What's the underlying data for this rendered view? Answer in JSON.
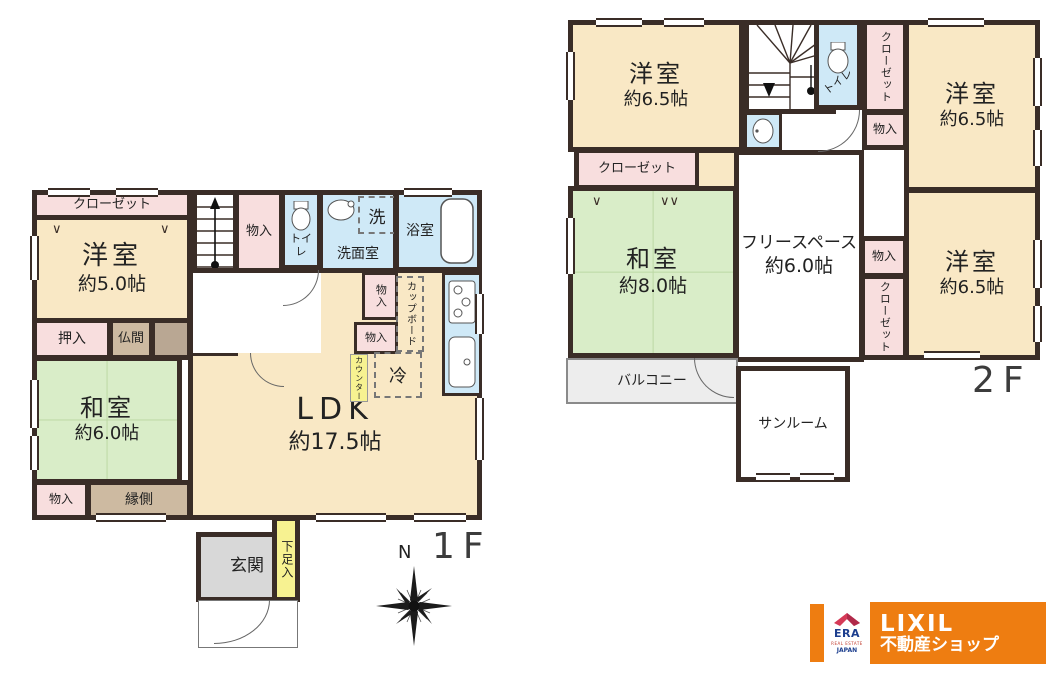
{
  "common": {
    "storage": "物入",
    "closet": "クローゼット",
    "toilet": "トイレ"
  },
  "floor1": {
    "floor_label": "1F",
    "compass_north": "N",
    "western_room": {
      "name": "洋室",
      "size": "約5.0帖"
    },
    "japanese_room": {
      "name": "和室",
      "size": "約6.0帖"
    },
    "ldk": {
      "name": "LDK",
      "size": "約17.5帖"
    },
    "oshiire": "押入",
    "butsuma": "仏間",
    "engawa": "縁側",
    "washroom": "洗面室",
    "washer": "洗",
    "bathroom": "浴室",
    "cupboard": "カップボード",
    "counter": "カウンター",
    "fridge": "冷",
    "genkan": "玄関",
    "shoe_storage": "下足入"
  },
  "floor2": {
    "floor_label": "2F",
    "western_room_nw": {
      "name": "洋室",
      "size": "約6.5帖"
    },
    "western_room_ne": {
      "name": "洋室",
      "size": "約6.5帖"
    },
    "western_room_se": {
      "name": "洋室",
      "size": "約6.5帖"
    },
    "japanese_room": {
      "name": "和室",
      "size": "約8.0帖"
    },
    "free_space": {
      "name": "フリースペース",
      "size": "約6.0帖"
    },
    "balcony": "バルコニー",
    "sunroom": "サンルーム"
  },
  "logo": {
    "brand": "LIXIL",
    "brand_sub": "不動産ショップ",
    "era": "ERA",
    "era_sub": "REAL ESTATE",
    "era_country": "JAPAN"
  },
  "colors": {
    "wall": "#3a2d27",
    "western_room": "#f9e8c5",
    "japanese_room": "#d9edc8",
    "closet": "#f8dede",
    "water": "#cfe9f7",
    "engawa": "#cdbaa1",
    "genkan": "#d8d8d8",
    "accent_yellow": "#f7f291",
    "balcony": "#ededed",
    "brand_orange": "#ee7d11",
    "era_red": "#d53a57",
    "era_blue": "#1c3e8e"
  }
}
